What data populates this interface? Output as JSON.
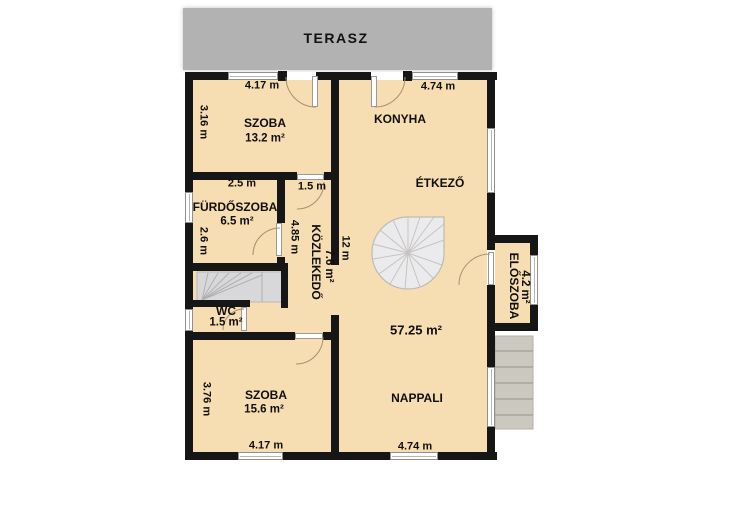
{
  "floor_plan": {
    "terrace_label": "TERASZ",
    "rooms": {
      "bedroom_top": {
        "name": "SZOBA",
        "area": "13.2 m²"
      },
      "kitchen": {
        "name": "KONYHA"
      },
      "dining": {
        "name": "ÉTKEZŐ"
      },
      "bathroom": {
        "name": "FÜRDŐSZOBA",
        "area": "6.5 m²"
      },
      "hallway": {
        "name": "KÖZLEKEDŐ",
        "area": "7.6 m²"
      },
      "wc": {
        "name": "WC",
        "area": "1.5 m²"
      },
      "entry": {
        "name": "ELŐSZOBA",
        "area": "4.2 m²"
      },
      "bedroom_bottom": {
        "name": "SZOBA",
        "area": "15.6 m²"
      },
      "living": {
        "name": "NAPPALI",
        "area": "57.25 m²"
      }
    },
    "dimensions": {
      "bedroom_top_width": "4.17 m",
      "bedroom_top_depth": "3.16 m",
      "kitchen_width": "4.74 m",
      "bathroom_width": "2.5 m",
      "bathroom_depth": "2.6 m",
      "hall_door_width": "1.5 m",
      "hall_length": "4.85 m",
      "main_room_depth": "12 m",
      "bedroom_bottom_depth": "3.76 m",
      "bedroom_bottom_width": "4.17 m",
      "living_width": "4.74 m"
    },
    "colors": {
      "floor": "#f6ddb2",
      "wall": "#161616",
      "terrace": "#b2b2b2",
      "stairs": "#d8d8da",
      "outdoor_steps": "#cbc8bf",
      "door_arc": "#a9906c"
    }
  }
}
